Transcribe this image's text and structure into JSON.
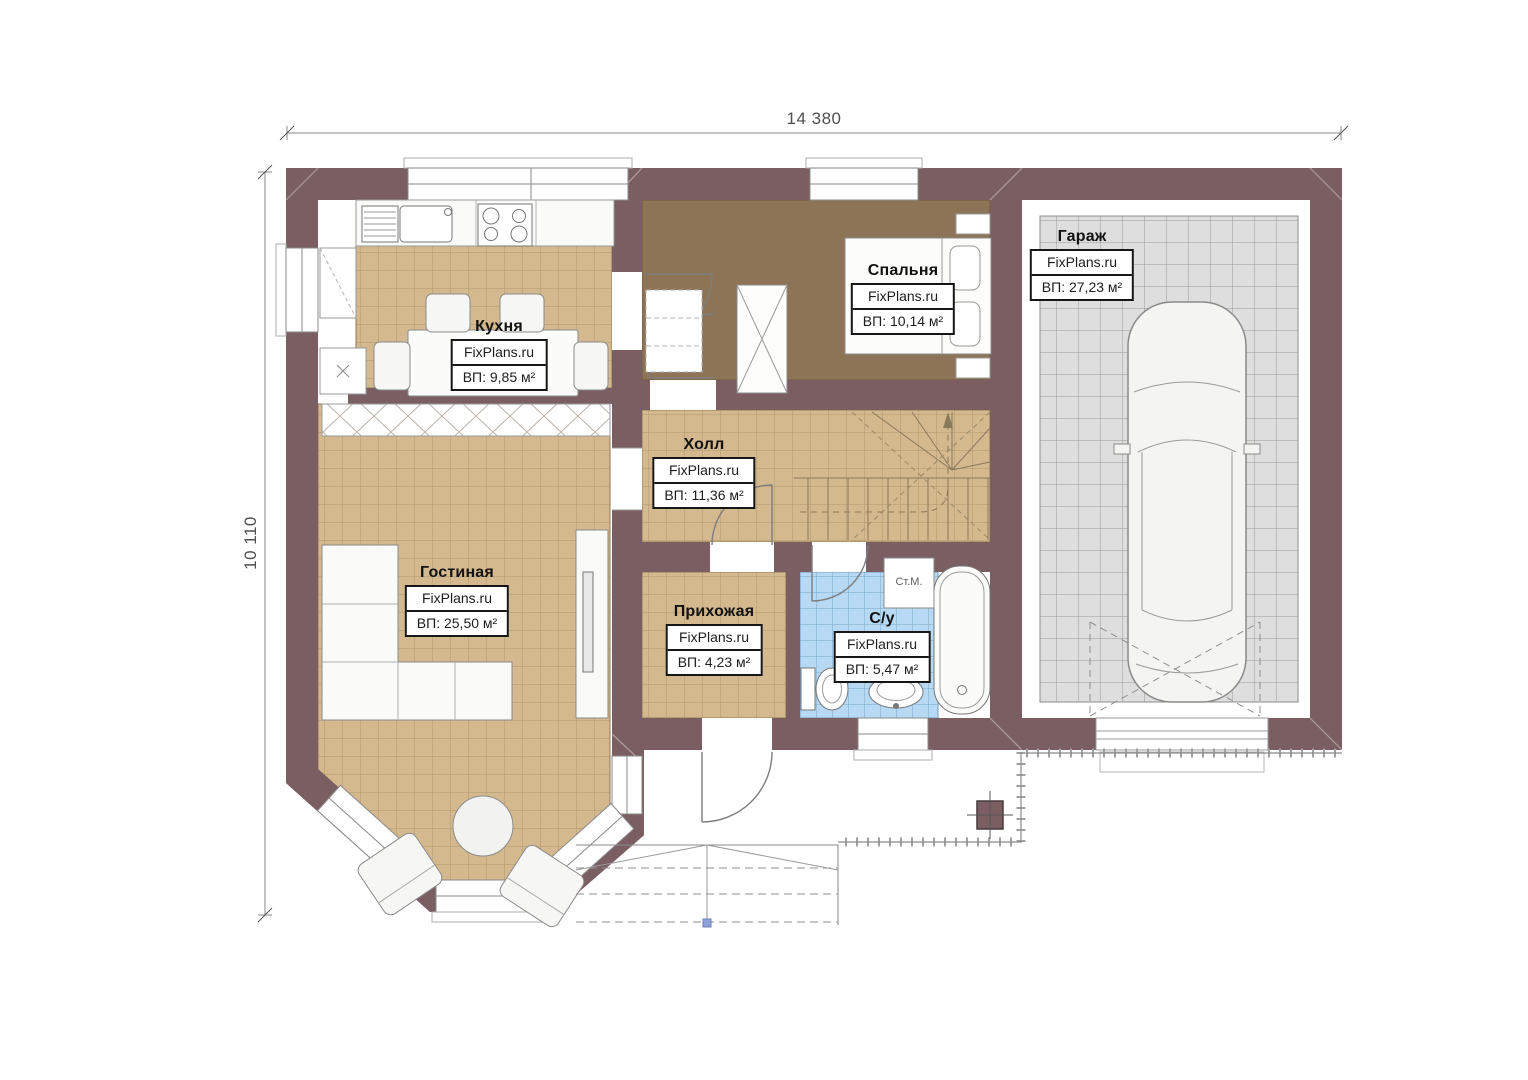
{
  "dimensions": {
    "top": "14 380",
    "left": "10 110"
  },
  "watermark": "FixPlans.ru",
  "rooms": {
    "kitchen": {
      "name": "Кухня",
      "watermark": "FixPlans.ru",
      "area": "ВП: 9,85 м²"
    },
    "bedroom": {
      "name": "Спальня",
      "watermark": "FixPlans.ru",
      "area": "ВП: 10,14 м²"
    },
    "garage": {
      "name": "Гараж",
      "watermark": "FixPlans.ru",
      "area": "ВП: 27,23 м²"
    },
    "hall": {
      "name": "Холл",
      "watermark": "FixPlans.ru",
      "area": "ВП: 11,36 м²"
    },
    "living_room": {
      "name": "Гостиная",
      "watermark": "FixPlans.ru",
      "area": "ВП: 25,50 м²"
    },
    "hallway": {
      "name": "Прихожая",
      "watermark": "FixPlans.ru",
      "area": "ВП: 4,23 м²"
    },
    "bathroom": {
      "name": "С/у",
      "watermark": "FixPlans.ru",
      "area": "ВП: 5,47 м²"
    }
  },
  "annotations": {
    "washing_machine": "Ст.М."
  },
  "colors": {
    "wall": "#7a5e62",
    "floor_tile": "#d4b88e",
    "bedroom_floor": "#8d7457",
    "garage_floor": "#dedede",
    "bathroom_tile": "#b7d9f3"
  }
}
